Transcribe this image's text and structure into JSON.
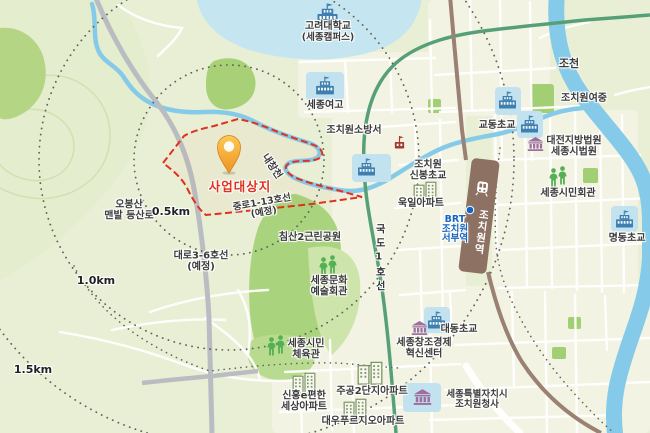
{
  "labels": {
    "korea_univ": {
      "line1": "고려대학교",
      "line2": "(세종캠퍼스)"
    },
    "sejong_girls_hs": {
      "text": "세종여고"
    },
    "jochun_river": {
      "text": "조천"
    },
    "jochiwon_girls_ms": {
      "text": "조치원여중"
    },
    "gyodong_elem": {
      "text": "교동초교"
    },
    "daejeon_court": {
      "line1": "대전지방법원",
      "line2": "세종시법원"
    },
    "sejong_civic_hall": {
      "text": "세종시민회관"
    },
    "myeongdong_elem": {
      "text": "명동초교"
    },
    "fire_station": {
      "text": "조치원소방서"
    },
    "sinbong_elem": {
      "line1": "조치원",
      "line2": "신봉초교"
    },
    "wookil_apt": {
      "text": "욱일아파트"
    },
    "brt_station": {
      "line1": "BRT",
      "line2": "조치원",
      "line3": "서부역"
    },
    "jochiwon_station": {
      "text": "조치원역"
    },
    "project_site": {
      "text": "사업대상지"
    },
    "naechang_stream": {
      "text": "내창천"
    },
    "obongsan_trail": {
      "line1": "오봉산",
      "line2": "맨발 등산로"
    },
    "ring_05": {
      "text": "0.5km"
    },
    "ring_10": {
      "text": "1.0km"
    },
    "ring_15": {
      "text": "1.5km"
    },
    "planned_midroad": {
      "line1": "중로1-13호선",
      "line2": "(예정)"
    },
    "planned_bigroad": {
      "line1": "대로3-6호선",
      "line2": "(예정)"
    },
    "chimsan_park": {
      "text": "침산2근린공원"
    },
    "national_road_1": {
      "text": "국도1호선"
    },
    "culture_hall": {
      "line1": "세종문화",
      "line2": "예술회관"
    },
    "civic_gym": {
      "line1": "세종시민",
      "line2": "체육관"
    },
    "daedong_elem": {
      "text": "대동초교"
    },
    "innovation_center": {
      "line1": "세종창조경제",
      "line2": "혁신센터"
    },
    "jugong_apt": {
      "text": "주공2단지아파트"
    },
    "shinheung_apt": {
      "line1": "신흥e편한",
      "line2": "세상아파트"
    },
    "daewoo_apt": {
      "text": "대우푸르지오아파트"
    },
    "city_hall": {
      "line1": "세종특별자치시",
      "line2": "조치원청사"
    }
  },
  "icons": {
    "location_pin": "orange teardrop marker on project site",
    "school": "blue school building with flag",
    "government": "purple columned public building",
    "fire_station": "dark red fire station building",
    "apartment": "outlined apartment towers",
    "people": "pair of green person figures",
    "train": "white train glyph on station",
    "brt_stop": "blue dot"
  },
  "colors": {
    "site_boundary": "#e0301e",
    "pin_orange": "#f09a2a",
    "water": "#85cbe9",
    "park_green": "#a9d37d",
    "road_gray": "#b9bdc2",
    "road_green": "#57a077",
    "railway_brown": "#9a8173",
    "station_brown": "#8d7263",
    "school_box_blue": "#c3e2f0",
    "school_icon_blue": "#3d7fae",
    "public_purple": "#9c6f9e",
    "people_green": "#53b153",
    "brt_blue": "#1565c0",
    "fire_red": "#a23b30"
  }
}
